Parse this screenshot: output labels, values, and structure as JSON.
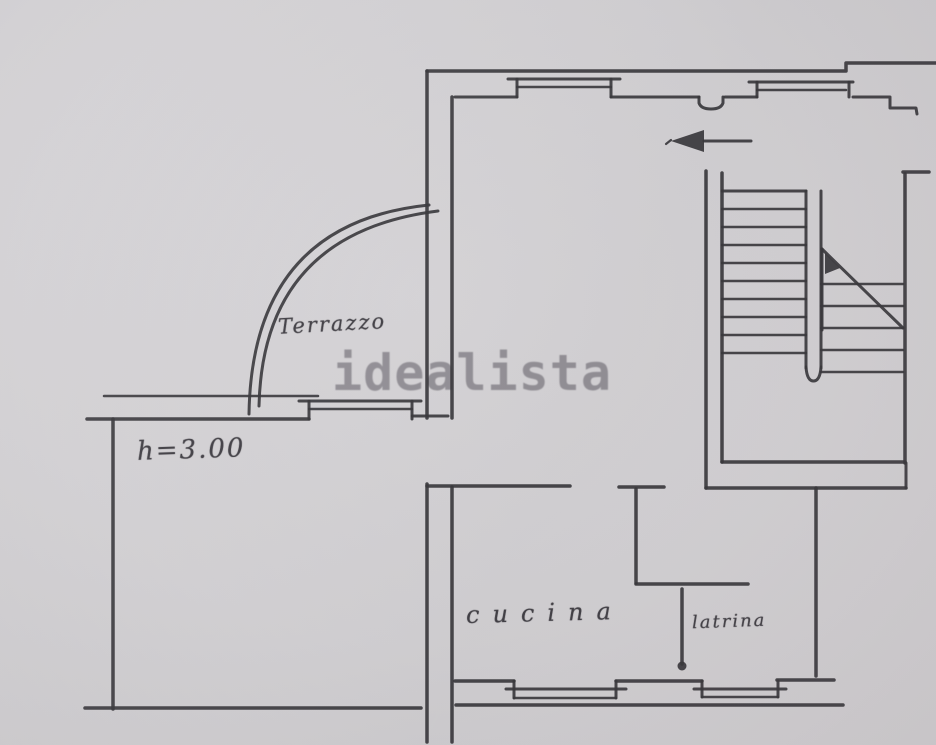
{
  "document": {
    "kind": "scanned floor plan",
    "watermark_text": "idealista"
  },
  "labels": {
    "terrace": "Terrazzo",
    "ceiling_height": "h=3.00",
    "kitchen": "cucina",
    "toilet": "latrina"
  },
  "drawing": {
    "north_arrow_direction": "left",
    "rooms_annotated": [
      "Terrazzo",
      "cucina",
      "latrina"
    ],
    "colors": {
      "paper": "#d4d2d5",
      "ink": "#3b393e",
      "watermark": "#8e8b93"
    }
  }
}
